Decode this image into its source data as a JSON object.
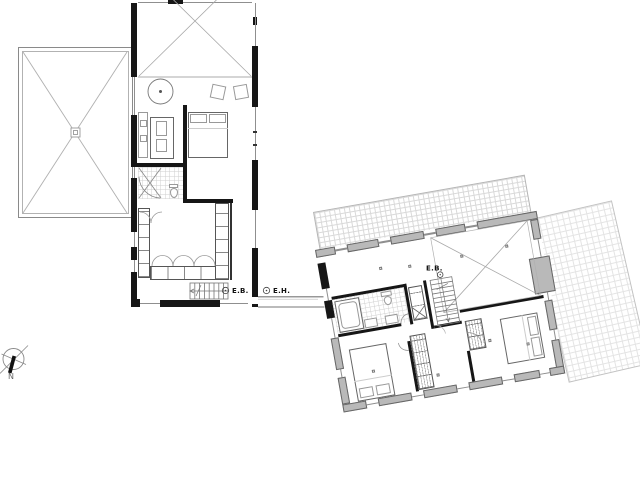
{
  "labels": {
    "level_marker_ground": "E.B.",
    "level_marker_house": "E.H.",
    "level_marker_upper": "E.B.",
    "north": "N"
  },
  "icons": {
    "compass": "north-compass-icon",
    "level_marker": "circle-level-marker-icon"
  },
  "colors": {
    "background": "#ffffff",
    "wall_black": "#161616",
    "wall_gray": "#b9b9b9",
    "wall_outline": "#666666",
    "thin_line": "#9a9a9a",
    "tile_line": "#d9d9d9",
    "bath_tile_line": "#cfcfcf"
  }
}
